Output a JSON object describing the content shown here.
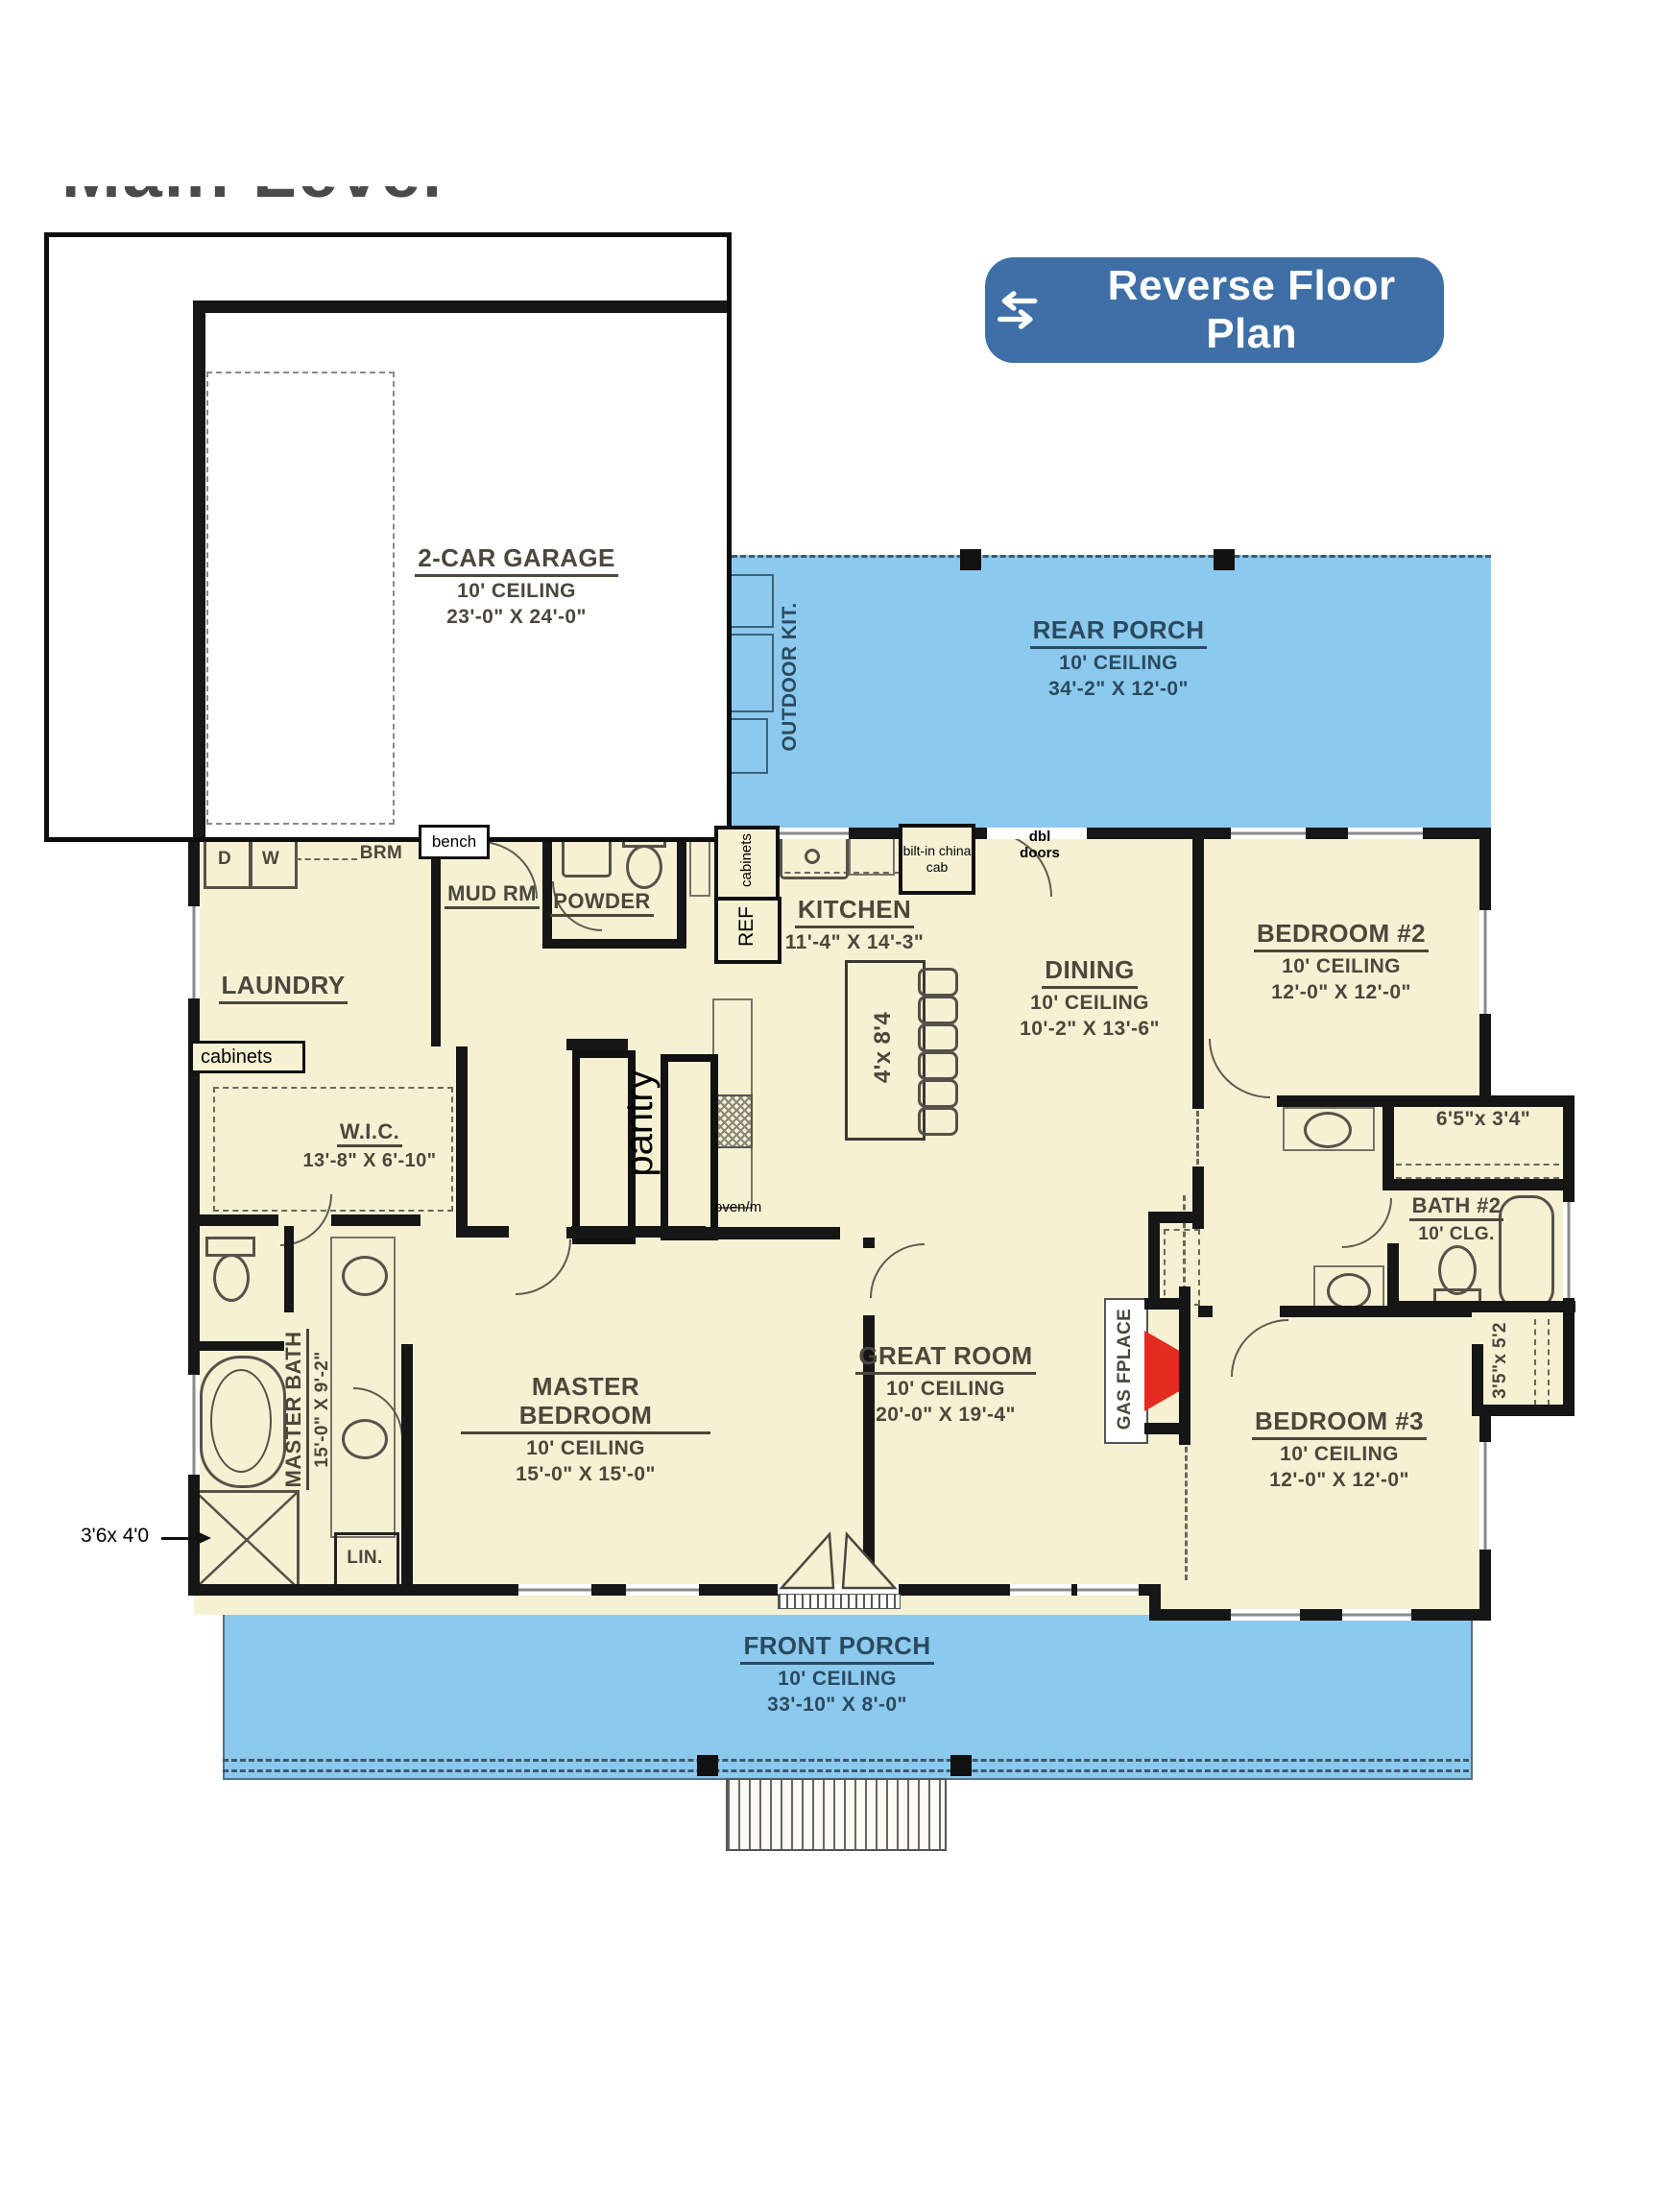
{
  "header": {
    "partial_title": "Main Level"
  },
  "controls": {
    "reverse_button": {
      "label": "Reverse Floor Plan",
      "icon": "swap-arrows"
    }
  },
  "colors": {
    "porch_blue": "#8bc9ee",
    "interior_cream": "#f6f1d3",
    "wall_black": "#161616",
    "button_blue": "#3e6fa6",
    "fireplace_red": "#e32b20",
    "plan_text": "#4b473c",
    "porch_text": "#2c4a5e"
  },
  "rooms": [
    {
      "id": "garage",
      "name": "2-CAR GARAGE",
      "ceiling": "10' CEILING",
      "dims": "23'-0\" X 24'-0\""
    },
    {
      "id": "rear_porch",
      "name": "REAR PORCH",
      "ceiling": "10' CEILING",
      "dims": "34'-2\" X 12'-0\""
    },
    {
      "id": "outdoor_kitchen",
      "name": "OUTDOOR KIT."
    },
    {
      "id": "laundry",
      "name": "LAUNDRY"
    },
    {
      "id": "mud_room",
      "name": "MUD RM"
    },
    {
      "id": "powder",
      "name": "POWDER"
    },
    {
      "id": "kitchen",
      "name": "KITCHEN",
      "dims": "11'-4\" X 14'-3\""
    },
    {
      "id": "dining",
      "name": "DINING",
      "ceiling": "10' CEILING",
      "dims": "10'-2\" X 13'-6\""
    },
    {
      "id": "bedroom2",
      "name": "BEDROOM #2",
      "ceiling": "10' CEILING",
      "dims": "12'-0\" X 12'-0\""
    },
    {
      "id": "bath2",
      "name": "BATH #2",
      "ceiling": "10' CLG."
    },
    {
      "id": "bedroom3",
      "name": "BEDROOM #3",
      "ceiling": "10' CEILING",
      "dims": "12'-0\" X 12'-0\""
    },
    {
      "id": "great_room",
      "name": "GREAT ROOM",
      "ceiling": "10' CEILING",
      "dims": "20'-0\" X 19'-4\""
    },
    {
      "id": "wic",
      "name": "W.I.C.",
      "dims": "13'-8\" X 6'-10\""
    },
    {
      "id": "master_bath",
      "name": "MASTER BATH",
      "dims": "15'-0\" X 9'-2\""
    },
    {
      "id": "master_bedroom",
      "name": "MASTER BEDROOM",
      "ceiling": "10' CEILING",
      "dims": "15'-0\" X 15'-0\""
    },
    {
      "id": "front_porch",
      "name": "FRONT PORCH",
      "ceiling": "10' CEILING",
      "dims": "33'-10\" X 8'-0\""
    }
  ],
  "annotations": {
    "bench": "bench",
    "laundry_cabinets": "cabinets",
    "kitchen_cabinets": "cabinets",
    "fridge": "REF",
    "china_cabinet": "bilt-in china cab",
    "double_doors": "dbl doors",
    "island_dims": "4'x 8'4",
    "pantry": "pantry",
    "oven": "oven/m",
    "fireplace": "GAS FPLACE",
    "closet_bed2": "6'5\"x 3'4\"",
    "closet_bed3": "3'5\"x 5'2",
    "shower_dims": "3'6x 4'0",
    "linen": "LIN.",
    "broom": "BRM",
    "dryer": "D",
    "washer": "W"
  }
}
